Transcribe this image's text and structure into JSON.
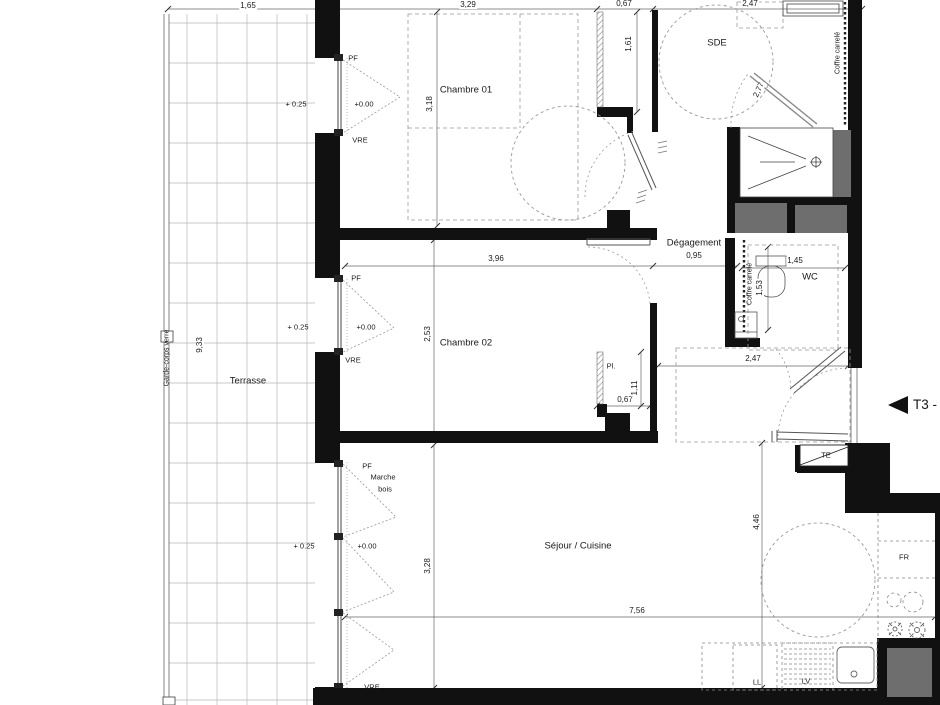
{
  "t": {
    "dim_165": "1,65",
    "dim_329": "3,29",
    "dim_067_top": "0,67",
    "dim_247_top": "2,47",
    "dim_318": "3,18",
    "dim_161": "1,61",
    "dim_277": "2,77",
    "dim_933": "9,33",
    "dim_396": "3,96",
    "dim_095": "0,95",
    "dim_145": "1,45",
    "dim_153": "1,53",
    "dim_253": "2,53",
    "dim_111": "1,11",
    "dim_067_pl": "0,67",
    "dim_247_entry": "2,47",
    "dim_446": "4,46",
    "dim_328": "3,28",
    "dim_756": "7,56",
    "room_chambre01": "Chambre 01",
    "room_sde": "SDE",
    "room_degagement": "Dégagement",
    "room_wc": "WC",
    "room_chambre02": "Chambre 02",
    "room_terrasse": "Terrasse",
    "room_sejour": "Séjour / Cuisine",
    "room_pl": "Pl.",
    "ann_pf": "PF",
    "ann_vre": "VRE",
    "ann_level_0": "+0.00",
    "ann_level_25": "+ 0.25",
    "ann_marche": "Marche",
    "ann_bois": "bois",
    "ann_garde_corps": "Garde-corps verre",
    "ann_coffre": "Coffre carrelé",
    "ann_te": "TE",
    "ann_fr": "FR",
    "ann_ll": "LL",
    "ann_lv": "LV",
    "tag_t3": "T3 - "
  },
  "colors": {
    "wall": "#111111",
    "duct_gray": "#6e6e6e",
    "line": "#444444",
    "dashed": "#999999",
    "background": "#ffffff"
  }
}
